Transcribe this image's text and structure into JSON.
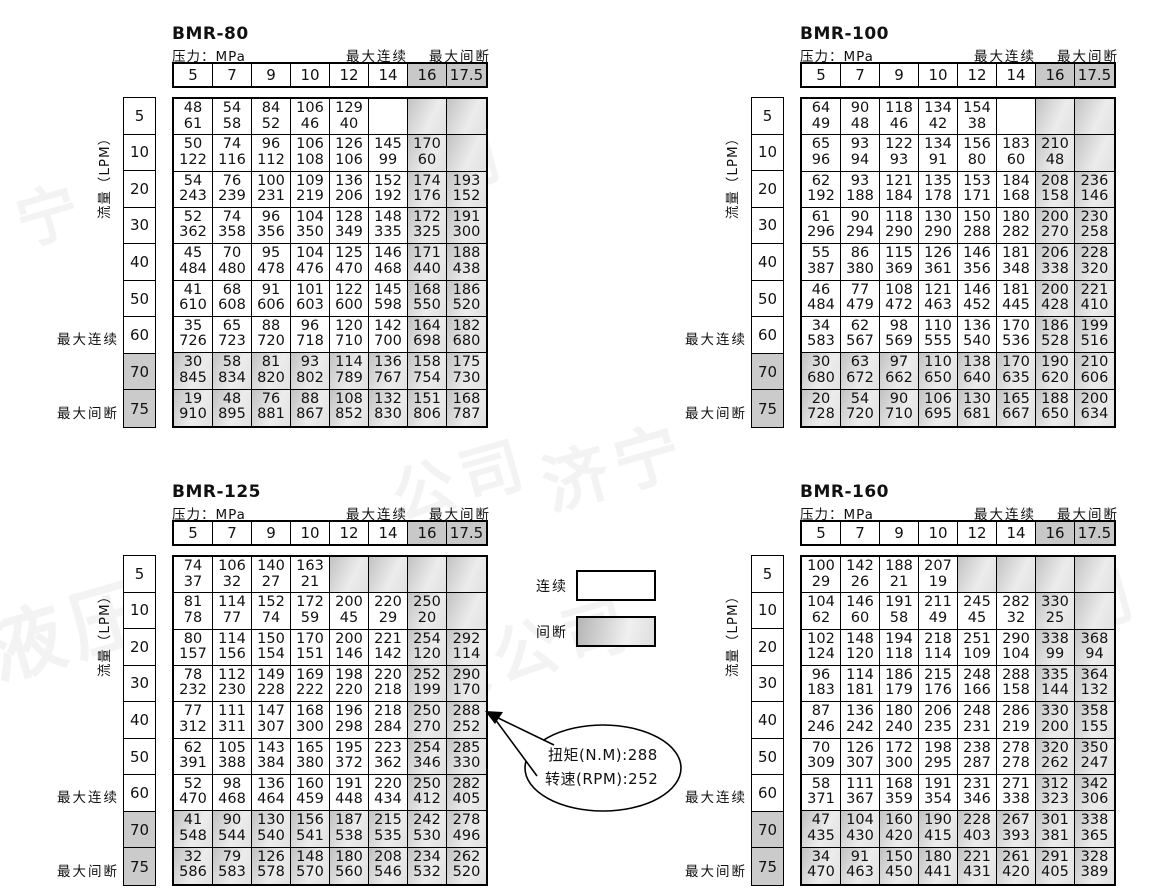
{
  "labels": {
    "pressure": "压力：MPa",
    "max_continuous": "最大连续",
    "max_intermittent": "最大间断",
    "flow": "流量（LPM）",
    "legend_continuous": "连续",
    "legend_intermittent": "间断",
    "callout_torque": "扭矩(N.M):288",
    "callout_speed": "转速(RPM):252"
  },
  "columns": [
    "5",
    "7",
    "9",
    "10",
    "12",
    "14",
    "16",
    "17.5"
  ],
  "rows": [
    "5",
    "10",
    "20",
    "30",
    "40",
    "50",
    "60",
    "70",
    "75"
  ],
  "cell_value_meaning": "top=torque N.M, bottom=speed RPM; '#'=empty gray zone, ''=empty white zone",
  "tables": [
    {
      "name": "BMR-80",
      "cells": [
        [
          "48|61",
          "54|58",
          "84|52",
          "106|46",
          "129|40",
          "",
          "#",
          "#"
        ],
        [
          "50|122",
          "74|116",
          "96|112",
          "106|108",
          "126|106",
          "145|99",
          "170|60",
          "#"
        ],
        [
          "54|243",
          "76|239",
          "100|231",
          "109|219",
          "136|206",
          "152|192",
          "174|176",
          "193|152"
        ],
        [
          "52|362",
          "74|358",
          "96|356",
          "104|350",
          "128|349",
          "148|335",
          "172|325",
          "191|300"
        ],
        [
          "45|484",
          "70|480",
          "95|478",
          "104|476",
          "125|470",
          "146|468",
          "171|440",
          "188|438"
        ],
        [
          "41|610",
          "68|608",
          "91|606",
          "101|603",
          "122|600",
          "145|598",
          "168|550",
          "186|520"
        ],
        [
          "35|726",
          "65|723",
          "88|720",
          "96|718",
          "120|710",
          "142|700",
          "164|698",
          "182|680"
        ],
        [
          "30|845",
          "58|834",
          "81|820",
          "93|802",
          "114|789",
          "136|767",
          "158|754",
          "175|730"
        ],
        [
          "19|910",
          "48|895",
          "76|881",
          "88|867",
          "108|852",
          "132|830",
          "151|806",
          "168|787"
        ]
      ]
    },
    {
      "name": "BMR-100",
      "cells": [
        [
          "64|49",
          "90|48",
          "118|46",
          "134|42",
          "154|38",
          "",
          "#",
          "#"
        ],
        [
          "65|96",
          "93|94",
          "122|93",
          "134|91",
          "156|80",
          "183|60",
          "210|48",
          "#"
        ],
        [
          "62|192",
          "93|188",
          "121|184",
          "135|178",
          "153|171",
          "184|168",
          "208|158",
          "236|146"
        ],
        [
          "61|296",
          "90|294",
          "118|290",
          "130|290",
          "150|288",
          "180|282",
          "200|270",
          "230|258"
        ],
        [
          "55|387",
          "86|380",
          "115|369",
          "126|361",
          "146|356",
          "181|348",
          "206|338",
          "228|320"
        ],
        [
          "46|484",
          "77|479",
          "108|472",
          "121|463",
          "146|452",
          "181|445",
          "200|428",
          "221|410"
        ],
        [
          "34|583",
          "62|567",
          "98|569",
          "110|555",
          "136|540",
          "170|536",
          "186|528",
          "199|516"
        ],
        [
          "30|680",
          "63|672",
          "97|662",
          "110|650",
          "138|640",
          "170|635",
          "190|620",
          "210|606"
        ],
        [
          "20|728",
          "54|720",
          "90|710",
          "106|695",
          "130|681",
          "165|667",
          "188|650",
          "200|634"
        ]
      ]
    },
    {
      "name": "BMR-125",
      "cells": [
        [
          "74|37",
          "106|32",
          "140|27",
          "163|21",
          "#",
          "#",
          "#",
          "#"
        ],
        [
          "81|78",
          "114|77",
          "152|74",
          "172|59",
          "200|45",
          "220|29",
          "250|20",
          "#"
        ],
        [
          "80|157",
          "114|156",
          "150|154",
          "170|151",
          "200|146",
          "221|142",
          "254|120",
          "292|114"
        ],
        [
          "78|232",
          "112|230",
          "149|228",
          "169|222",
          "198|220",
          "220|218",
          "252|199",
          "290|170"
        ],
        [
          "77|312",
          "111|311",
          "147|307",
          "168|300",
          "196|298",
          "218|284",
          "250|270",
          "288|252"
        ],
        [
          "62|391",
          "105|388",
          "143|384",
          "165|380",
          "195|372",
          "223|362",
          "254|346",
          "285|330"
        ],
        [
          "52|470",
          "98|468",
          "136|464",
          "160|459",
          "191|448",
          "220|434",
          "250|412",
          "282|405"
        ],
        [
          "41|548",
          "90|544",
          "130|540",
          "156|541",
          "187|538",
          "215|535",
          "242|530",
          "278|496"
        ],
        [
          "32|586",
          "79|583",
          "126|578",
          "148|570",
          "180|560",
          "208|546",
          "234|532",
          "262|520"
        ]
      ]
    },
    {
      "name": "BMR-160",
      "cells": [
        [
          "100|29",
          "142|26",
          "188|21",
          "207|19",
          "#",
          "#",
          "#",
          "#"
        ],
        [
          "104|62",
          "146|60",
          "191|58",
          "211|49",
          "245|45",
          "282|32",
          "330|25",
          "#"
        ],
        [
          "102|124",
          "148|120",
          "194|118",
          "218|114",
          "251|109",
          "290|104",
          "338|99",
          "368|94"
        ],
        [
          "96|183",
          "114|181",
          "186|179",
          "215|176",
          "248|166",
          "288|158",
          "335|144",
          "364|132"
        ],
        [
          "87|246",
          "136|242",
          "180|240",
          "206|235",
          "248|231",
          "286|219",
          "330|200",
          "358|155"
        ],
        [
          "70|309",
          "126|307",
          "172|300",
          "198|295",
          "238|287",
          "278|278",
          "320|262",
          "350|247"
        ],
        [
          "58|371",
          "111|367",
          "168|359",
          "191|354",
          "231|346",
          "271|338",
          "312|323",
          "342|306"
        ],
        [
          "47|435",
          "104|430",
          "160|420",
          "190|415",
          "228|403",
          "267|393",
          "301|381",
          "338|365"
        ],
        [
          "34|470",
          "91|463",
          "150|450",
          "180|441",
          "221|431",
          "261|420",
          "291|405",
          "328|389"
        ]
      ]
    }
  ],
  "watermarks": [
    {
      "text": "宁",
      "x": 15,
      "y": 165,
      "size": 62,
      "rot": -16
    },
    {
      "text": "有限公司",
      "x": 230,
      "y": 140,
      "size": 62,
      "rot": -16
    },
    {
      "text": "有限",
      "x": 880,
      "y": 140,
      "size": 62,
      "rot": -16
    },
    {
      "text": "济宁",
      "x": 540,
      "y": 415,
      "size": 66,
      "rot": -16
    },
    {
      "text": "公司",
      "x": 390,
      "y": 430,
      "size": 62,
      "rot": -16
    },
    {
      "text": "液压",
      "x": -15,
      "y": 570,
      "size": 76,
      "rot": -16
    },
    {
      "text": "限公司",
      "x": 420,
      "y": 600,
      "size": 64,
      "rot": -16
    },
    {
      "text": "公司",
      "x": 1000,
      "y": 560,
      "size": 62,
      "rot": -16
    }
  ]
}
